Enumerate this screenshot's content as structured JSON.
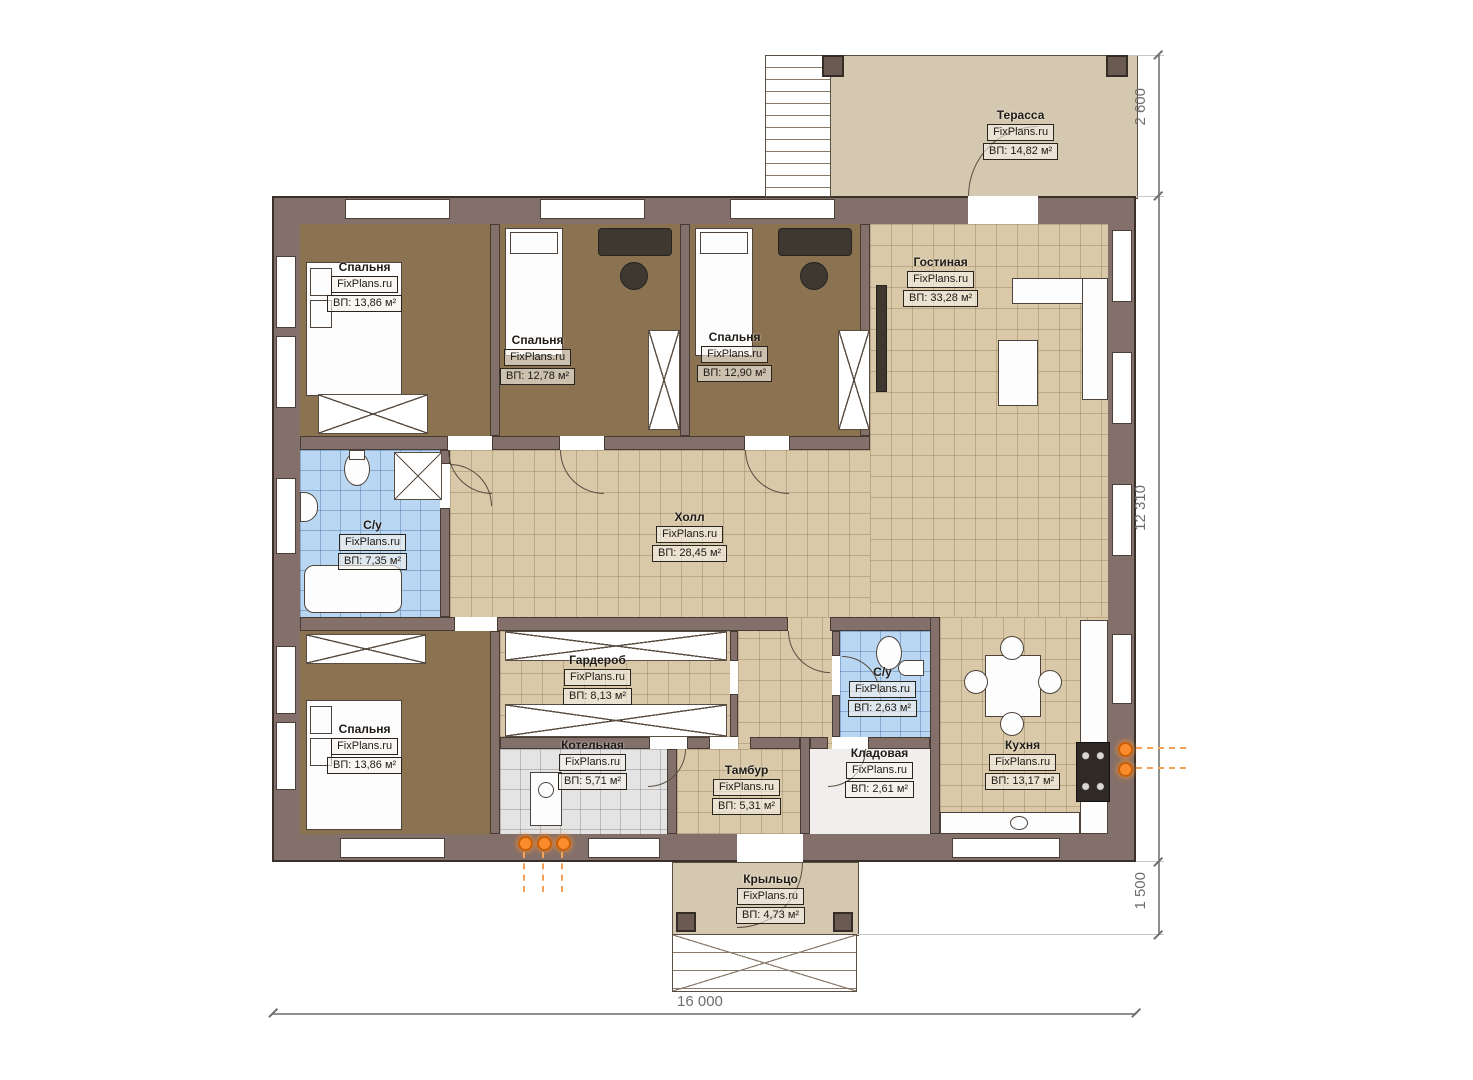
{
  "watermark": "FixPlans.ru",
  "rooms": [
    {
      "id": "terrace",
      "name": "Терасса",
      "area": "ВП: 14,82 м²"
    },
    {
      "id": "bedroom-top-left",
      "name": "Спальня",
      "area": "ВП: 13,86 м²"
    },
    {
      "id": "bedroom-top-mid",
      "name": "Спальня",
      "area": "ВП: 12,78 м²"
    },
    {
      "id": "bedroom-top-right",
      "name": "Спальня",
      "area": "ВП: 12,90 м²"
    },
    {
      "id": "living-room",
      "name": "Гостиная",
      "area": "ВП: 33,28 м²"
    },
    {
      "id": "bathroom-main",
      "name": "С/у",
      "area": "ВП: 7,35 м²"
    },
    {
      "id": "hall",
      "name": "Холл",
      "area": "ВП: 28,45 м²"
    },
    {
      "id": "wardrobe",
      "name": "Гардероб",
      "area": "ВП: 8,13 м²"
    },
    {
      "id": "bedroom-bottom",
      "name": "Спальня",
      "area": "ВП: 13,86 м²"
    },
    {
      "id": "boiler-room",
      "name": "Котельная",
      "area": "ВП: 5,71 м²"
    },
    {
      "id": "vestibule",
      "name": "Тамбур",
      "area": "ВП: 5,31 м²"
    },
    {
      "id": "bathroom-small",
      "name": "С/у",
      "area": "ВП: 2,63 м²"
    },
    {
      "id": "storage",
      "name": "Кладовая",
      "area": "ВП: 2,61 м²"
    },
    {
      "id": "kitchen",
      "name": "Кухня",
      "area": "ВП: 13,17 м²"
    },
    {
      "id": "porch",
      "name": "Крыльцо",
      "area": "ВП: 4,73 м²"
    }
  ],
  "dimensions": {
    "terrace_depth": "2 600",
    "building_height": "12 310",
    "porch_depth": "1 500",
    "building_width": "16 000"
  },
  "colors": {
    "wall": "#84706a",
    "floor_bedroom": "#8b7352",
    "floor_tile": "#d9c9a8",
    "floor_bath": "#b9d7f2",
    "floor_boiler": "#e4e4e4",
    "floor_terrace": "#d5c8b0",
    "utility_accent": "#fb8c2e",
    "dimension_text": "#6e6e6e"
  }
}
